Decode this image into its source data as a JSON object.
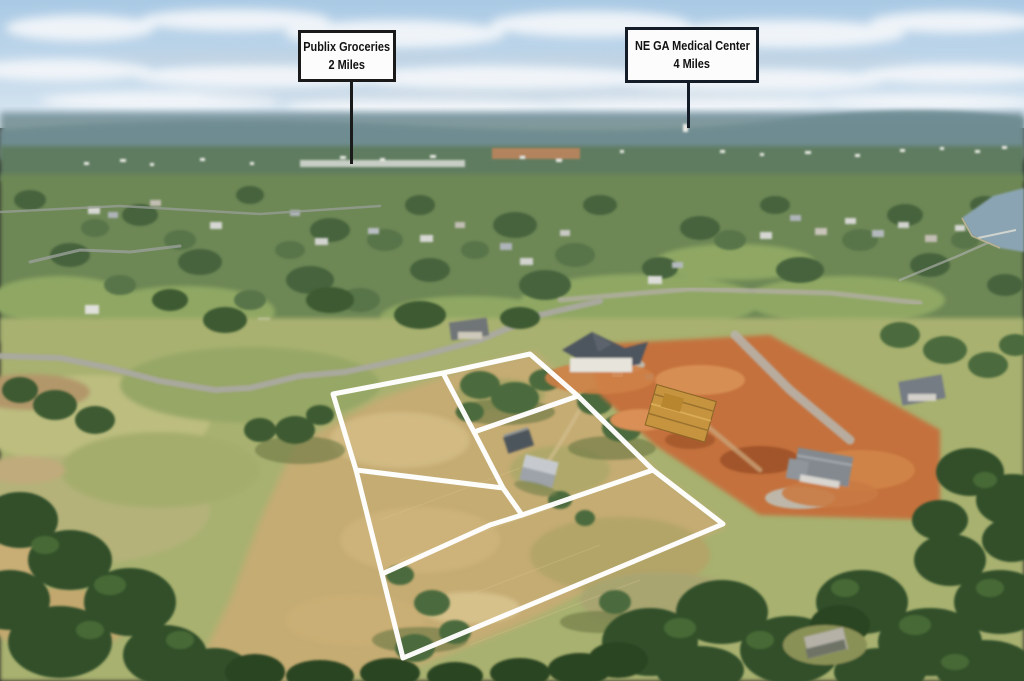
{
  "callouts": [
    {
      "id": "publix",
      "line1": "Publix Groceries",
      "line2": "2 Miles"
    },
    {
      "id": "medical",
      "line1": "NE GA Medical Center",
      "line2": "4 Miles"
    }
  ],
  "overlay": {
    "lot_line_color": "#ffffff",
    "callout_border_color": "#1a1a1a",
    "leader_line_color": "#1a1a1a"
  }
}
